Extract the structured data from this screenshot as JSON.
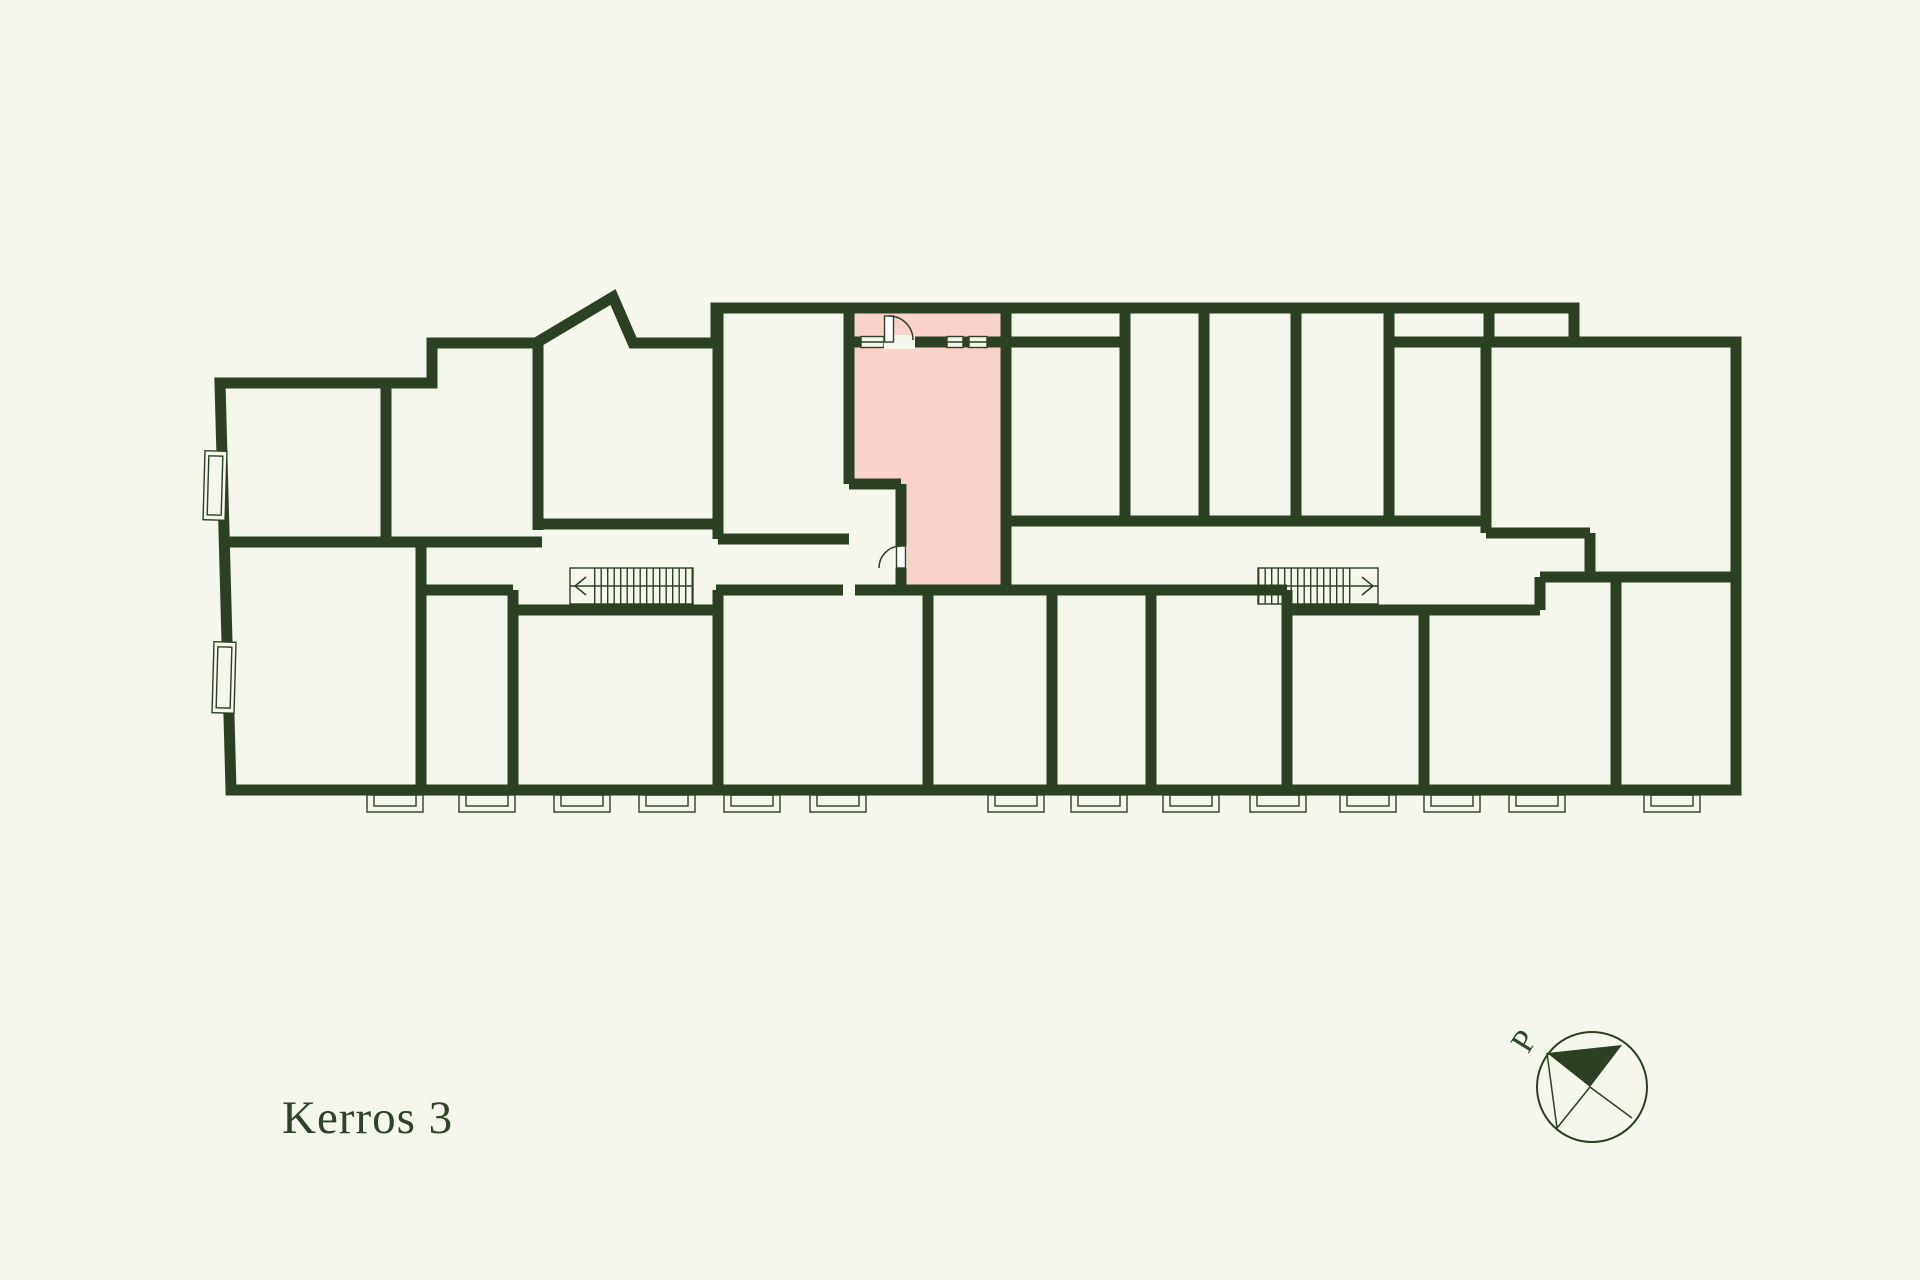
{
  "colors": {
    "bg": "#f5f6ec",
    "wall": "#2c4023",
    "pink": "#f9d3cb",
    "line": "#2c4023",
    "text": "#2e4327"
  },
  "plan": {
    "title": "Kerros 3",
    "compass_label": "P",
    "highlight_color": "#f9d3cb"
  }
}
